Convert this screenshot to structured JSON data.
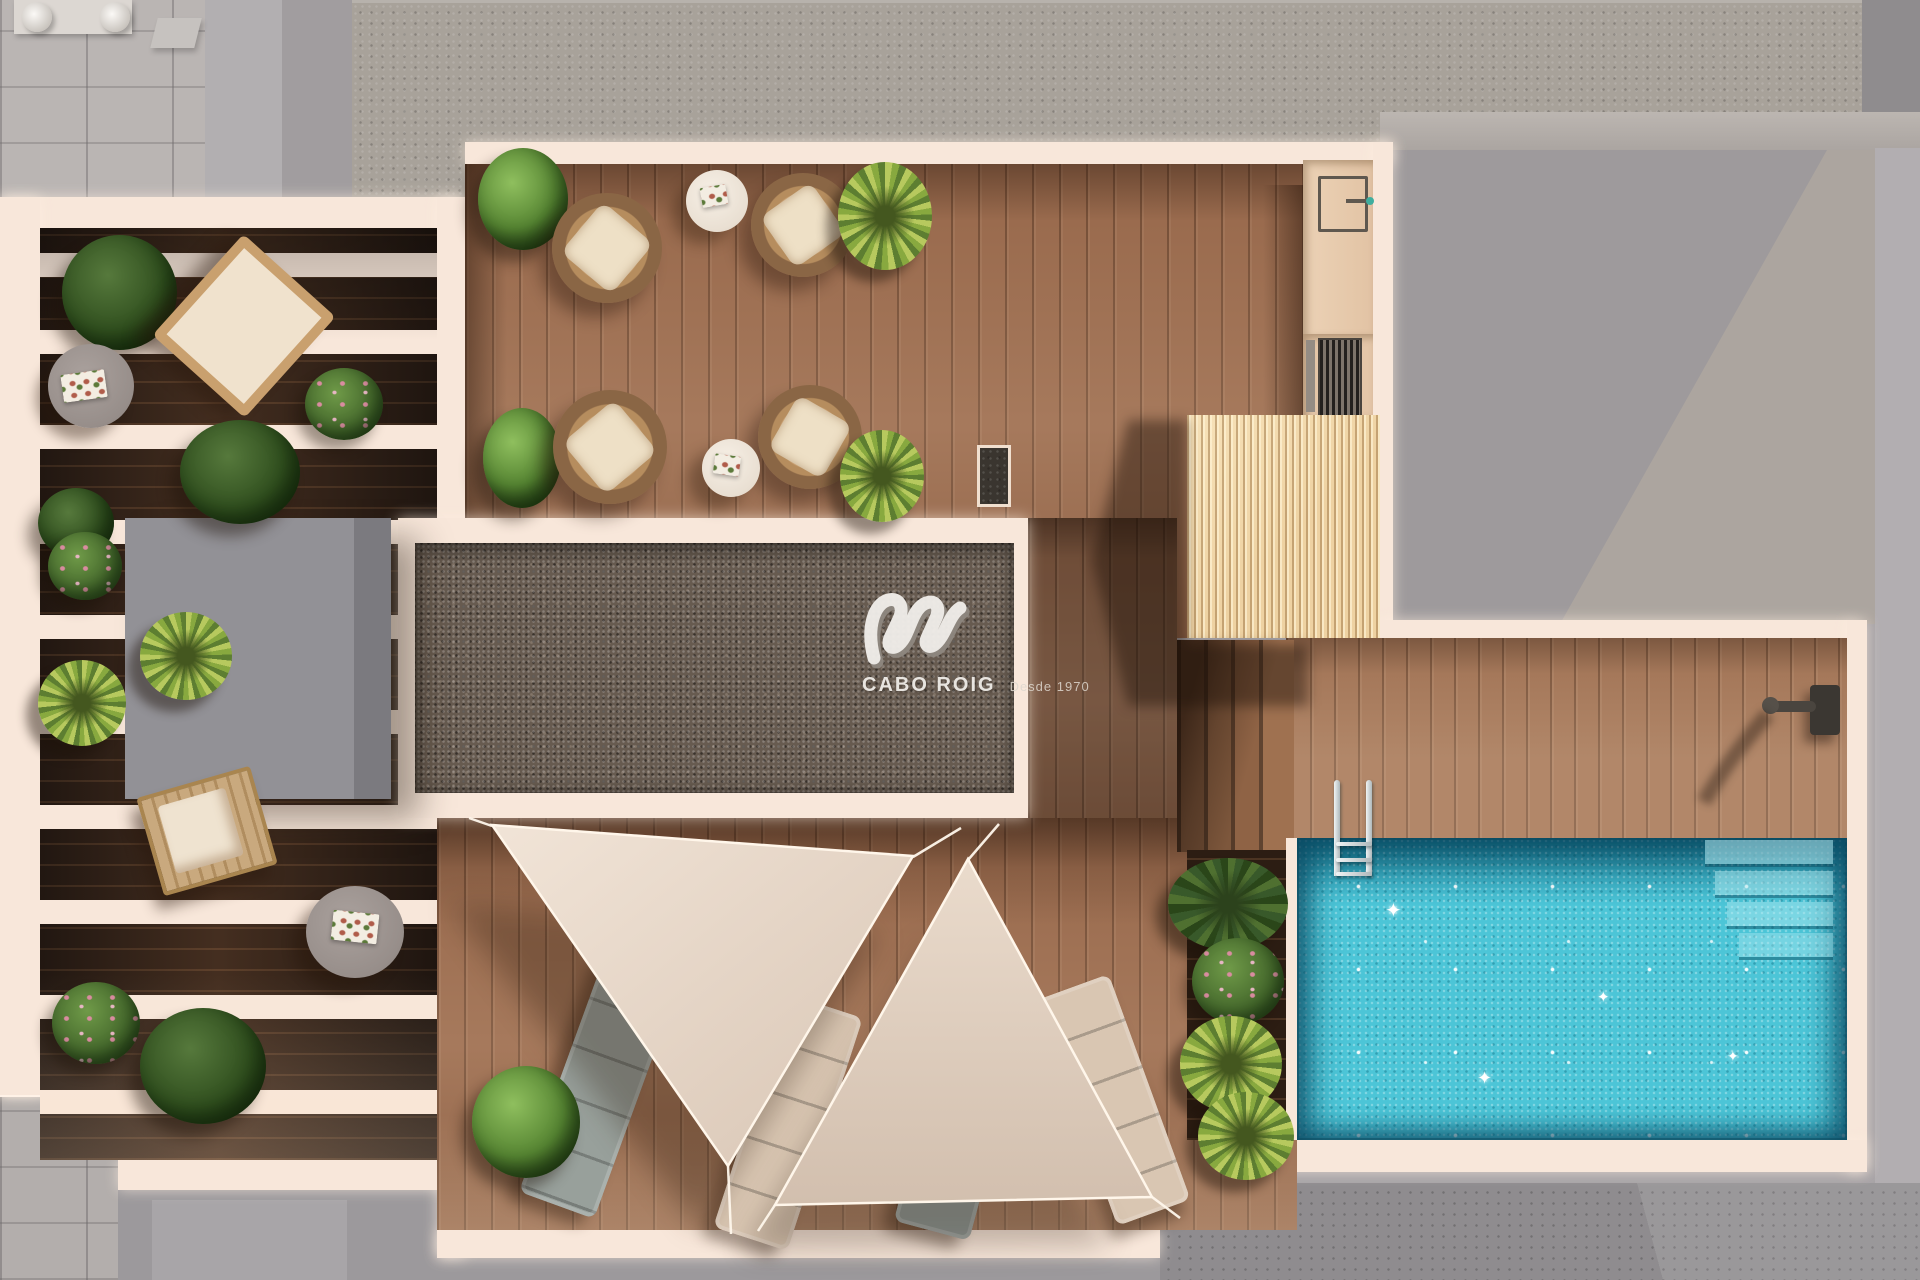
{
  "watermark": {
    "brand": "CABO ROIG",
    "tagline": "Desde 1970",
    "logo_icon": "wave-swoosh-logo"
  },
  "palette": {
    "--bg": "#a7a3a6",
    "--pavement": "#bab5b3",
    "--roof-a": "#a19d9f",
    "--roof-a-lit": "#b2afb1",
    "--roof-b": "#a8a29a",
    "--roof-c": "#9e9a9c",
    "--roof-c-lit": "#aca59f",
    "--right-strip": "#b2aeb1",
    "--cream": "#f8e7da",
    "--cream-bright": "#fff3e9",
    "--wood-deck": "#9a6b4e",
    "--wood-dark": "#33231a",
    "--wood-pool": "#a5785a",
    "--gravel": "#675b50",
    "--slats": "#eed2a2",
    "--water": "#4cc5d7",
    "--water-dark": "#1d87a0",
    "--sail": "#e9dacc",
    "--sail2": "#e0d0c2",
    "--gray-box": "#8c8b90",
    "--lounger-gray": "#98a09b",
    "--lounger-beige": "#d9c6b2",
    "--green": "#5e8a38",
    "--yucca": "#b7c95e",
    "--flower": "#d98ca0",
    "--table-gray": "#a29a96",
    "--table-white": "#f4ece2",
    "--chrome": "#d7dcdd"
  },
  "scene": {
    "type": "rooftop-terrace-floor-plan-render",
    "view": "top-down 3D architectural render",
    "areas": [
      "street-pavement",
      "neighbour-roofs",
      "pergola-wing",
      "dining-deck",
      "gravel-skylight",
      "outdoor-kitchen",
      "slatted-pergola",
      "stairs",
      "pool-deck",
      "swimming-pool",
      "sunbathing-deck"
    ],
    "objects": {
      "wicker_chairs": 4,
      "cafe_tables": 2,
      "side_tables_gray": 2,
      "deck_chairs_wing": 2,
      "sun_loungers": 4,
      "shade_sails": 2,
      "pool_ladder": 1,
      "outdoor_shower": 1,
      "bbq_grill": 1,
      "sink_fixture": 1,
      "roof_vents": 2,
      "plants": 18,
      "pool_steps": 4
    }
  }
}
